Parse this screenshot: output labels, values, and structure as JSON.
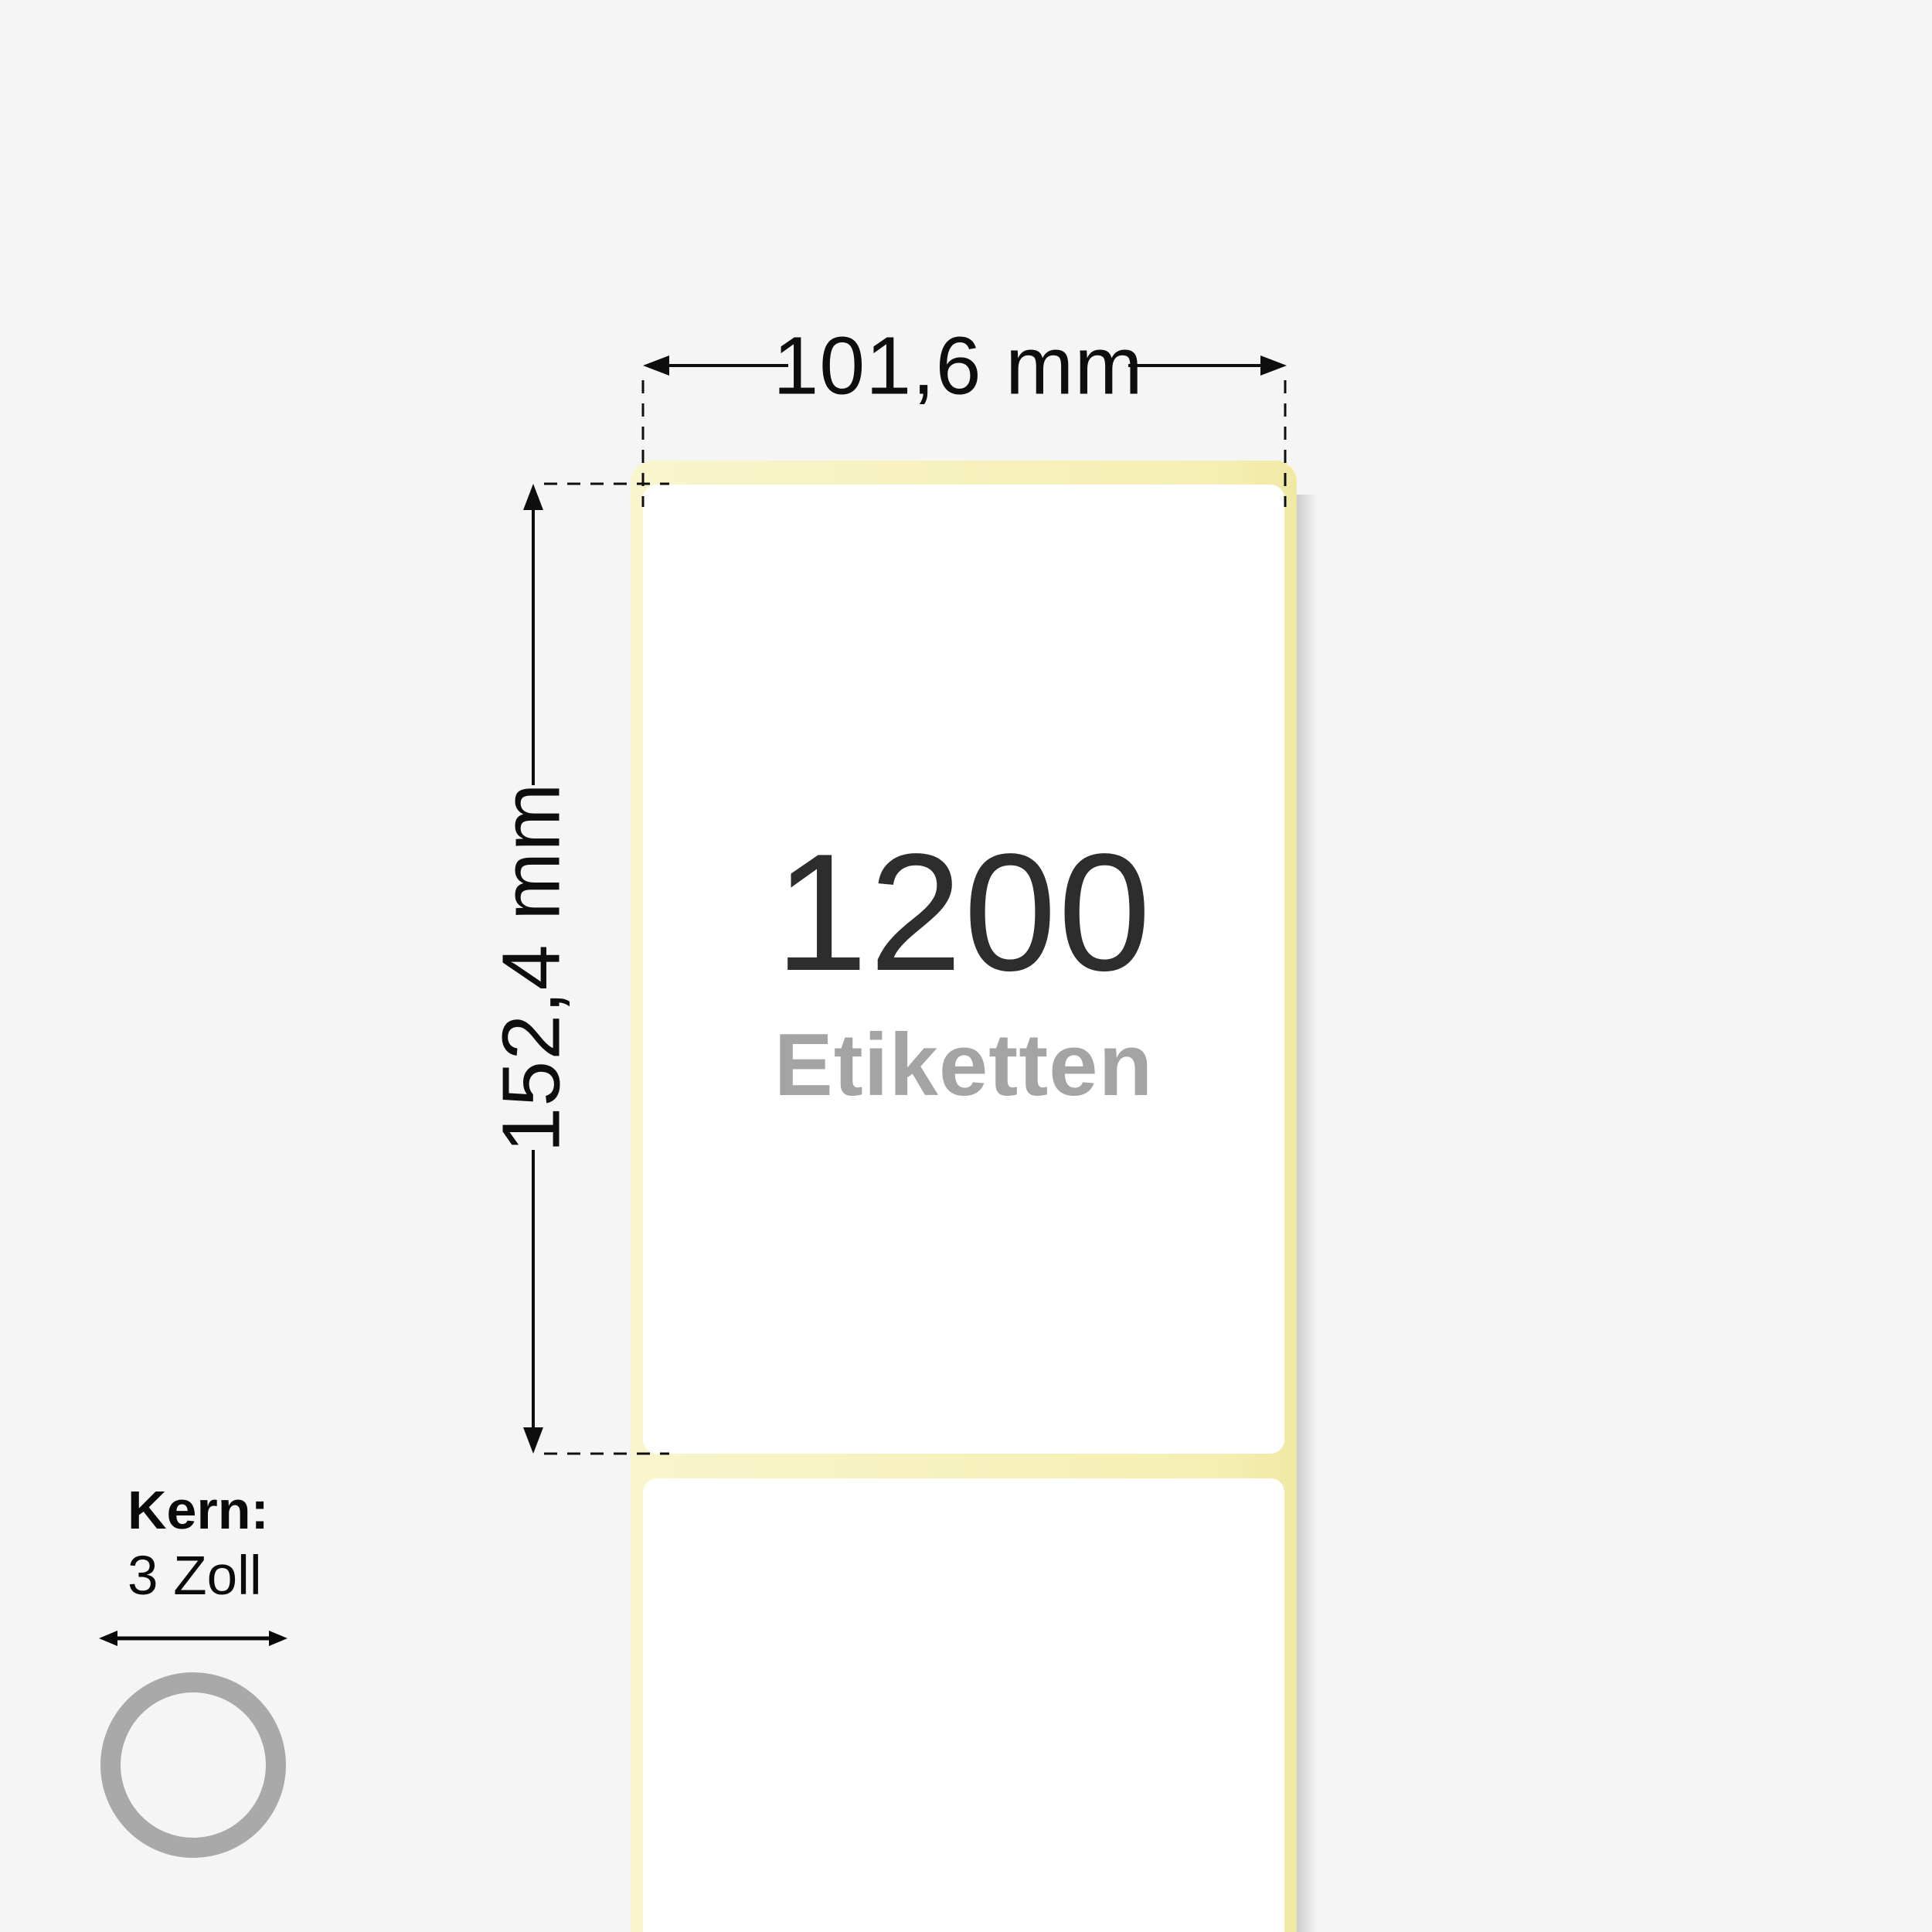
{
  "page": {
    "type": "product-dimension-diagram"
  },
  "label_roll": {
    "count": "1200",
    "count_caption": "Etiketten",
    "width_dimension": "101,6 mm",
    "height_dimension": "152,4 mm",
    "core": {
      "title": "Kern:",
      "size": "3 Zoll"
    }
  },
  "colors": {
    "background": "#f5f5f5",
    "liner_yellow": "#f6f1bb",
    "label_white": "#ffffff",
    "count_text": "#2d2d2d",
    "caption_text": "#a4a4a4",
    "dimension_ink": "#0e0e0e",
    "core_ring_gray": "#a9a9a9"
  }
}
